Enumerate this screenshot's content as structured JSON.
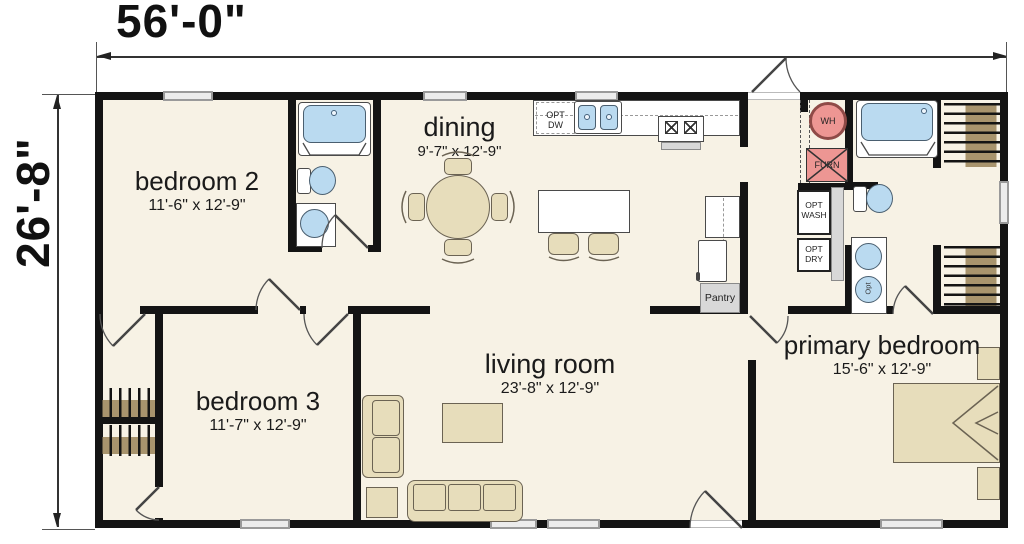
{
  "plan": {
    "overall_width": "56'-0\"",
    "overall_height": "26'-8\"",
    "rooms": {
      "bedroom2": {
        "name": "bedroom 2",
        "size": "11'-6\" x 12'-9\""
      },
      "dining": {
        "name": "dining",
        "size": "9'-7\" x 12'-9\""
      },
      "bedroom3": {
        "name": "bedroom 3",
        "size": "11'-7\" x 12'-9\""
      },
      "living_room": {
        "name": "living room",
        "size": "23'-8\" x 12'-9\""
      },
      "primary_bedroom": {
        "name": "primary bedroom",
        "size": "15'-6\" x 12'-9\""
      }
    },
    "labels": {
      "opt_dishwasher": "OPT\nDW",
      "water_heater": "WH",
      "furnace": "FURN",
      "opt_washer": "OPT\nWASH",
      "opt_dryer": "OPT\nDRY",
      "pantry": "Pantry",
      "opt_sink": "Opt"
    },
    "colors": {
      "floor": "#f7f2e5",
      "wall": "#141414",
      "fixture_blue": "#badaf0",
      "furniture_tan": "#e7ddbb",
      "mechanical_pink": "#ed9693",
      "window_gray": "#9a9a9a"
    }
  }
}
